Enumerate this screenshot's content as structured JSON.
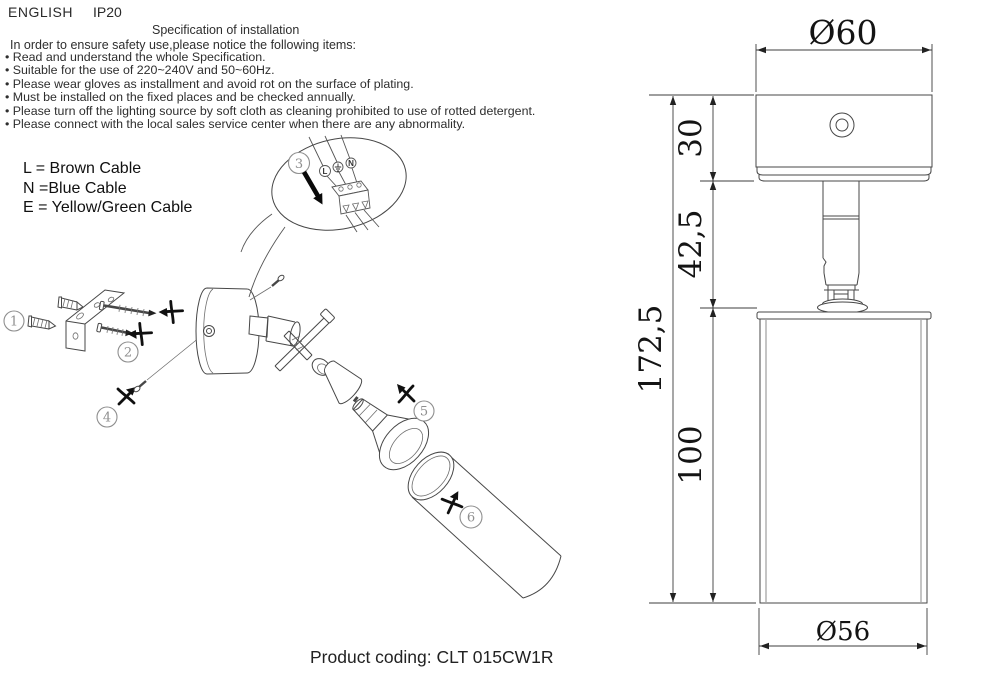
{
  "header": {
    "language": "ENGLISH",
    "ip_rating": "IP20"
  },
  "spec": {
    "title": "Specification of installation",
    "intro": "In order to ensure safety use,please notice the following items:",
    "items": [
      "Read and understand the whole Specification.",
      "Suitable for the use of 220~240V and 50~60Hz.",
      "Please wear gloves as installment and avoid rot on the surface of plating.",
      "Must be installed on the fixed places and be checked annually.",
      "Please turn off the lighting source by soft cloth as cleaning prohibited to use of rotted detergent.",
      "Please connect with the local sales service center when there are any abnormality."
    ]
  },
  "cable_legend": {
    "live": "L = Brown Cable",
    "neutral": "N =Blue Cable",
    "earth": "E = Yellow/Green Cable"
  },
  "wiring_callout": {
    "step": "3",
    "terminal_labels": {
      "live": "L",
      "neutral": "N"
    },
    "earth_icon": "earth-ground-icon"
  },
  "assembly_steps": {
    "step1": "1",
    "step2": "2",
    "step4": "4",
    "step5": "5",
    "step6": "6"
  },
  "dimensions": {
    "canopy_diameter": "Ø60",
    "canopy_height": "30",
    "stem_height": "42,5",
    "total_height": "172,5",
    "body_height": "100",
    "body_diameter": "Ø56"
  },
  "footer": {
    "product_coding": "Product coding: CLT 015CW1R"
  }
}
